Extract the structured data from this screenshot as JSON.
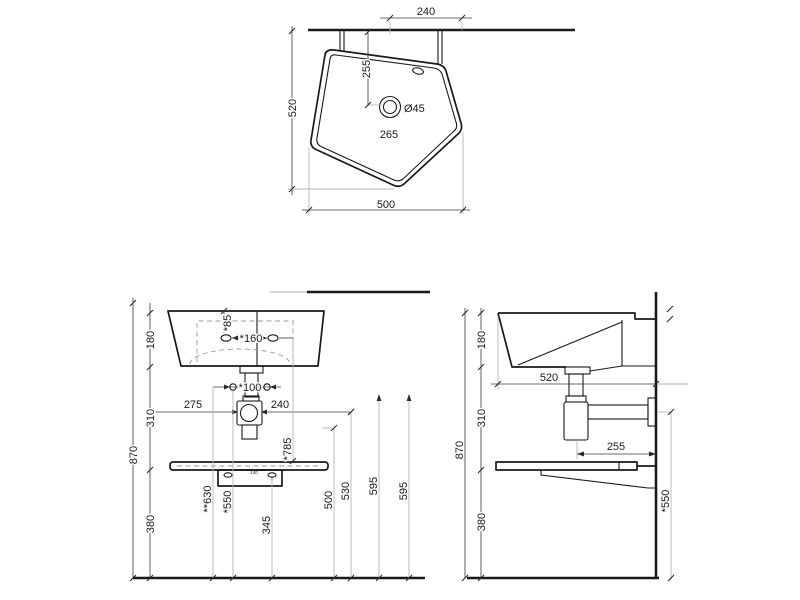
{
  "drawing": {
    "type": "washbasin-technical-drawing",
    "background": "#ffffff",
    "line_color": "#1a1a1a",
    "views": {
      "plan": {
        "dims": {
          "d240": "240",
          "d255": "255",
          "drain_dia": "Ø45",
          "d265": "265",
          "d520": "520",
          "d500": "500"
        }
      },
      "front": {
        "dims": {
          "d180": "180",
          "d85": "*85",
          "d160": "*160",
          "d100": "*100",
          "d275": "275",
          "d240": "240",
          "d310": "310",
          "d870": "870",
          "d630": "**630",
          "d550": "*550",
          "d345": "345",
          "d785": "*785",
          "d500": "500",
          "d530": "530",
          "d595a": "595",
          "d595b": "595",
          "d380": "380",
          "bracket_small": "140"
        }
      },
      "side": {
        "dims": {
          "d180": "180",
          "d520": "520",
          "d310": "310",
          "d870": "870",
          "d255": "255",
          "d380": "380",
          "d550": "*550"
        }
      }
    }
  }
}
